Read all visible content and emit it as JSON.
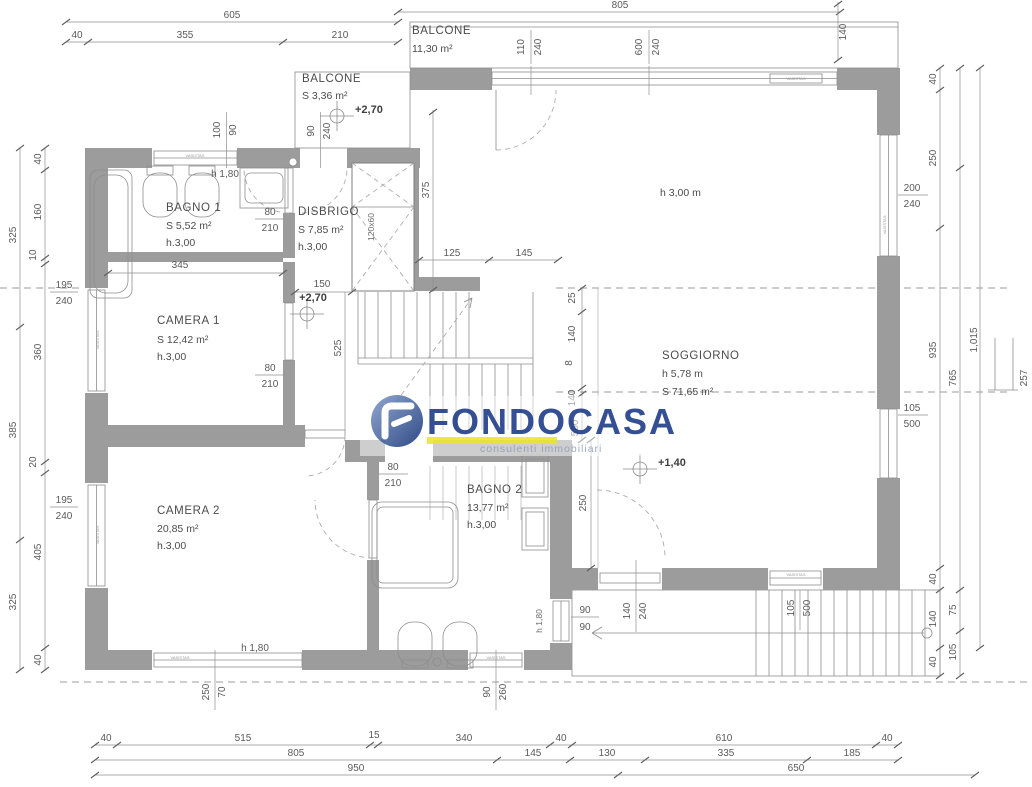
{
  "rooms": {
    "balcone_top": {
      "name": "BALCONE",
      "area": "11,30 m²"
    },
    "balcone_small": {
      "name": "BALCONE",
      "area": "S 3,36 m²"
    },
    "bagno1": {
      "name": "BAGNO 1",
      "area": "S 5,52 m²",
      "height": "h.3,00"
    },
    "disbrigo": {
      "name": "DISBRIGO",
      "area": "S 7,85 m²",
      "height": "h.3,00"
    },
    "camera1": {
      "name": "CAMERA 1",
      "area": "S 12,42 m²",
      "height": "h.3,00"
    },
    "soggiorno": {
      "name": "SOGGIORNO",
      "height": "h 5,78 m",
      "area": "S 71,65 m²",
      "ceiling_note": "h 3,00 m"
    },
    "camera2": {
      "name": "CAMERA 2",
      "area": "20,85 m²",
      "height": "h.3,00"
    },
    "bagno2": {
      "name": "BAGNO 2",
      "area": "13,77 m²",
      "height": "h.3,00"
    }
  },
  "levels": {
    "balcony": "+2,70",
    "disbrigo": "+2,70",
    "hall": "+1,40"
  },
  "window_tag": "VASISTAS",
  "lift_label": "120x60",
  "edge_mark": "257",
  "dims": {
    "top": [
      "605",
      "40",
      "355",
      "210",
      "805",
      "140"
    ],
    "top_win": [
      "110",
      "240",
      "600",
      "240",
      "100",
      "90",
      "90",
      "240"
    ],
    "left": [
      "40",
      "160",
      "10",
      "360",
      "20",
      "405",
      "40",
      "325",
      "385",
      "325"
    ],
    "left_win": [
      "195",
      "240",
      "195",
      "240"
    ],
    "right": [
      "40",
      "250",
      "935",
      "40",
      "140",
      "40",
      "765",
      "75",
      "105",
      "1,015"
    ],
    "right_win": [
      "200",
      "240",
      "105",
      "500"
    ],
    "bottom": [
      "40",
      "515",
      "15",
      "340",
      "40",
      "610",
      "40",
      "805",
      "145",
      "130",
      "335",
      "185",
      "950",
      "650"
    ],
    "bottom_win": [
      "250",
      "70",
      "90",
      "260"
    ],
    "interior": [
      "h 1,80",
      "80",
      "210",
      "345",
      "150",
      "525",
      "375",
      "125",
      "145",
      "80",
      "210",
      "25",
      "140",
      "8",
      "140",
      "560",
      "250",
      "80",
      "210",
      "90",
      "90",
      "140",
      "240",
      "105",
      "500",
      "h 1,80",
      "h 1,80"
    ]
  },
  "logo": {
    "name": "FONDOCASA",
    "tagline": "consulenti immobiliari",
    "blue": "#24418c",
    "yellow": "#ece73a"
  }
}
